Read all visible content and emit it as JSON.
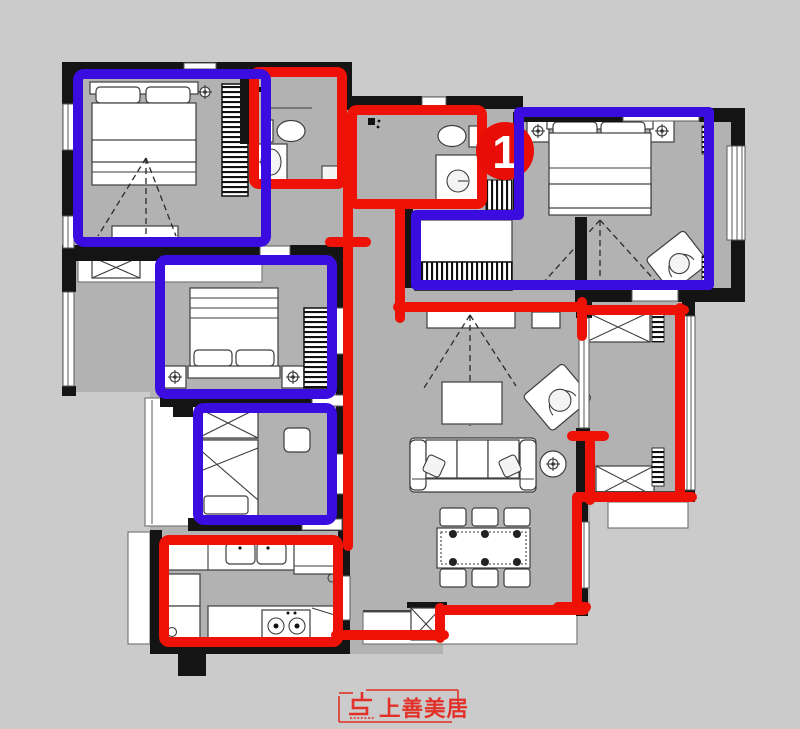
{
  "canvas": {
    "background": "#cbcbcb",
    "floor_color": "#b2b2b2",
    "wall_color": "#141414"
  },
  "annotations": {
    "red_color": "#ee1105",
    "blue_color": "#3a0ce0",
    "red_outlined_areas": [
      "bathroom-top-left",
      "bathroom-center",
      "kitchen",
      "right-balcony",
      "circulation-path"
    ],
    "blue_outlined_areas": [
      "bedroom-top-left",
      "master-suite-with-cloakroom",
      "bedroom-middle-left",
      "study"
    ]
  },
  "marker": {
    "label": "1",
    "fill": "#e80d06",
    "text_color": "#ffffff"
  },
  "logo": {
    "text": "上善美居",
    "color": "#e23028"
  }
}
